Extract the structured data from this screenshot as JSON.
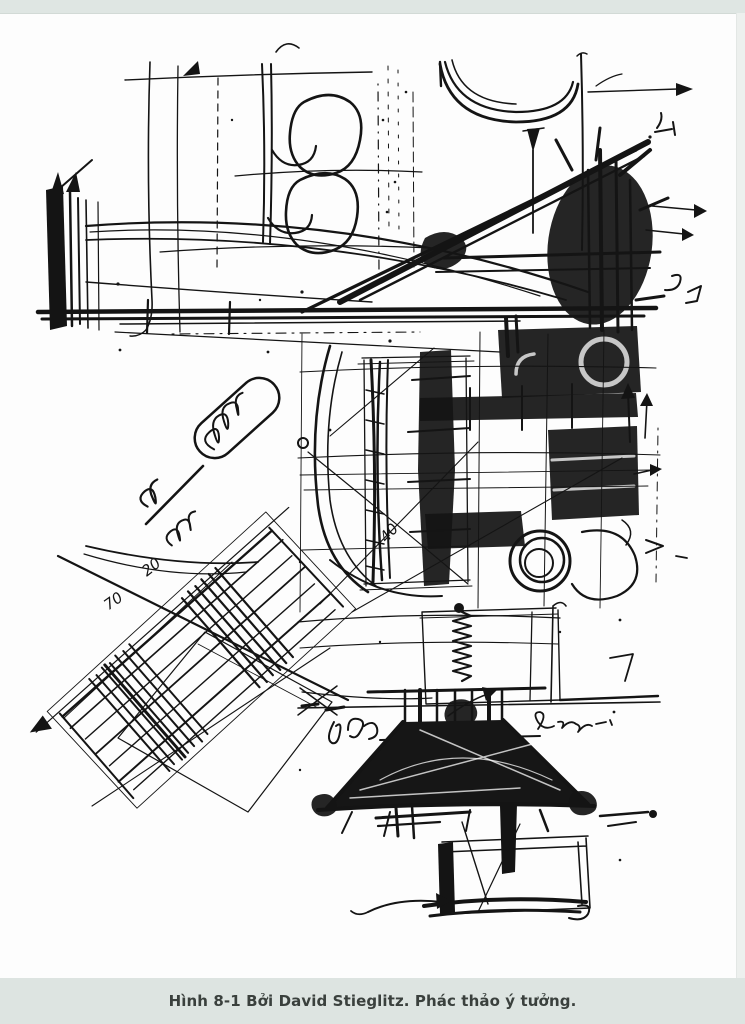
{
  "page": {
    "background": "#fdfdfd",
    "margin_band_color": "#dfe6e3",
    "right_strip_color": "#edf0ee",
    "ink_color": "#141414"
  },
  "caption": {
    "text": "Hình 8-1 Bởi David Stieglitz. Phác thảo ý tưởng.",
    "bar_color": "#dde4e1",
    "text_color": "#3a403d"
  },
  "sketch": {
    "annotations": {
      "note_20": "20",
      "note_70": "70",
      "note_40": "40"
    }
  }
}
